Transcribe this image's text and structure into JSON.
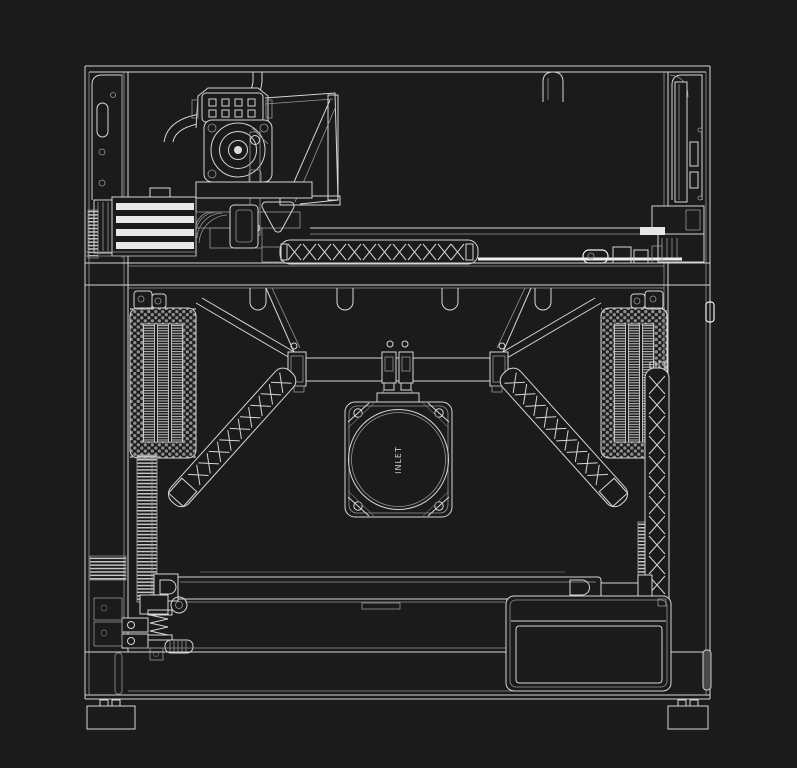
{
  "fan": {
    "label": "INLET"
  },
  "colors": {
    "bg": "#1b1b1b",
    "line": "#d6d6d6",
    "bright": "#f4f4f4",
    "dim": "#979797",
    "faint": "#6f6f6f"
  }
}
